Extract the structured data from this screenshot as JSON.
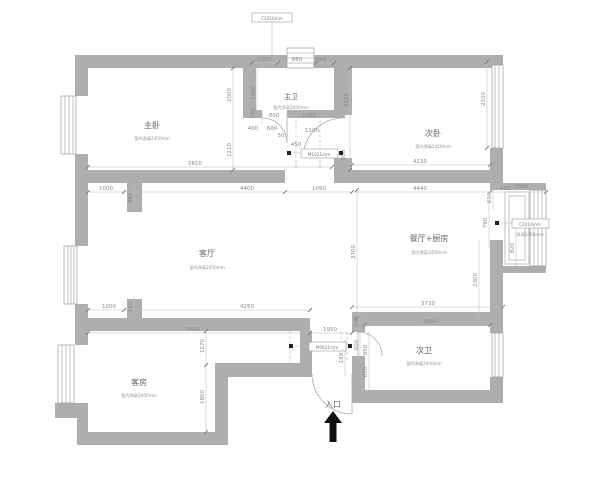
{
  "plan": {
    "rooms": [
      {
        "name": "主卧",
        "height_note": "室内净高2450mm"
      },
      {
        "name": "主卫",
        "height_note": "室内净高2450mm"
      },
      {
        "name": "次卧",
        "height_note": "室内净高2450mm"
      },
      {
        "name": "客厅",
        "height_note": "室内净高2450mm"
      },
      {
        "name": "餐厅+厨房",
        "height_note": "室内净高2450mm"
      },
      {
        "name": "次卫",
        "height_note": "室内净高2450mm"
      },
      {
        "name": "客房",
        "height_note": "室内净高2450mm"
      }
    ],
    "entrance": {
      "label": "入口"
    },
    "tags": [
      {
        "text": "C1510mm"
      },
      {
        "text": "C2410mm",
        "sub": "净高2450mm"
      },
      {
        "text": "M0921mm"
      },
      {
        "text": "M1021mm"
      }
    ],
    "dims": [
      {
        "v": "1050"
      },
      {
        "v": "860"
      },
      {
        "v": "840"
      },
      {
        "v": "2000"
      },
      {
        "v": "1880"
      },
      {
        "v": "2100"
      },
      {
        "v": "2100"
      },
      {
        "v": "250"
      },
      {
        "v": "800"
      },
      {
        "v": "1300"
      },
      {
        "v": "400"
      },
      {
        "v": "600"
      },
      {
        "v": "50"
      },
      {
        "v": "1100"
      },
      {
        "v": "450"
      },
      {
        "v": "800"
      },
      {
        "v": "5610"
      },
      {
        "v": "4230"
      },
      {
        "v": "1210"
      },
      {
        "v": "1000"
      },
      {
        "v": "4400"
      },
      {
        "v": "1090"
      },
      {
        "v": "4440"
      },
      {
        "v": "610"
      },
      {
        "v": "450"
      },
      {
        "v": "1000"
      },
      {
        "v": "790"
      },
      {
        "v": "820"
      },
      {
        "v": "2300"
      },
      {
        "v": "3700"
      },
      {
        "v": "1000"
      },
      {
        "v": "110"
      },
      {
        "v": "4250"
      },
      {
        "v": "5500"
      },
      {
        "v": "1950"
      },
      {
        "v": "3730"
      },
      {
        "v": "3550"
      },
      {
        "v": "250"
      },
      {
        "v": "600"
      },
      {
        "v": "850"
      },
      {
        "v": "650"
      },
      {
        "v": "150"
      },
      {
        "v": "1070"
      },
      {
        "v": "1800"
      },
      {
        "v": "480"
      }
    ],
    "colors": {
      "wall": "#aeaeae",
      "line": "#9b9b9b",
      "text": "#8a8a8a"
    }
  }
}
